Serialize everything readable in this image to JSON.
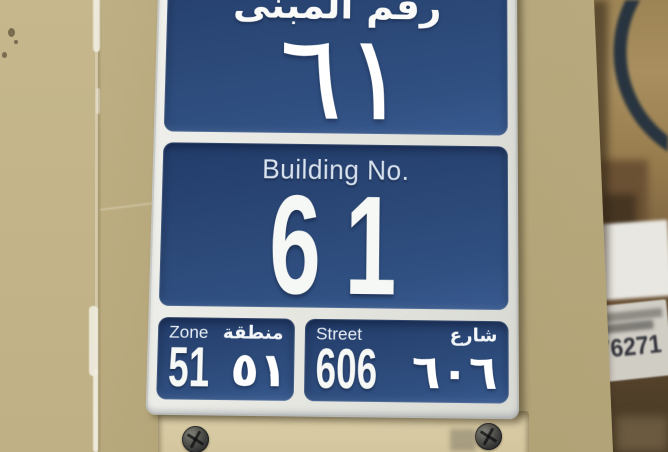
{
  "sign": {
    "building_title_ar": "رقم المبنى",
    "building_no_ar": "٦١",
    "building_label_en": "Building No.",
    "building_no_en": "61",
    "zone": {
      "label_en": "Zone",
      "label_ar": "منطقة",
      "value_en": "51",
      "value_ar": "٥١"
    },
    "street": {
      "label_en": "Street",
      "label_ar": "شارع",
      "value_en": "606",
      "value_ar": "٦٠٦"
    }
  },
  "background": {
    "sticker_number": "76271"
  },
  "colors": {
    "sign_blue": "#2c4a78",
    "sign_border_white": "#e9e9e4",
    "wall_beige": "#c3b489",
    "plate_beige": "#d5c7a0",
    "hose_dark": "#22303e",
    "text_white": "#f4f6f4",
    "sticker_digits": "#33343c"
  }
}
